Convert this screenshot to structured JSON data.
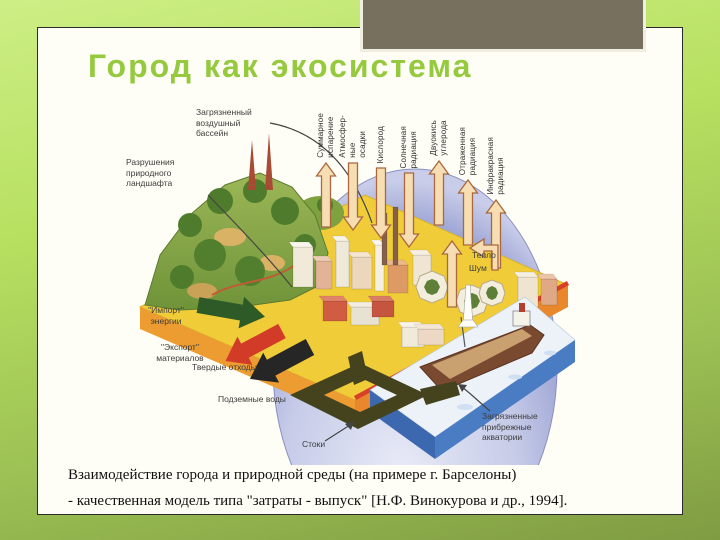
{
  "slide": {
    "title": "Город как экосистема",
    "caption": [
      "Взаимодействие города и природной среды (на примере г. Барселоны)",
      " - качественная модель типа \"затраты - выпуск\" [Н.Ф. Винокурова и др., 1994]."
    ]
  },
  "diagram": {
    "flows": [
      {
        "id": "total-evaporation",
        "label": "Суммарное\nиспарение",
        "dir": "up",
        "x": 206,
        "y_base": 132,
        "y_tip": 68,
        "label_bottom": 63
      },
      {
        "id": "atmospheric-precipitation",
        "label": "Атмосфер-\nные\nосадки",
        "dir": "down",
        "x": 233,
        "y_base": 68,
        "y_tip": 135,
        "label_bottom": 63
      },
      {
        "id": "oxygen",
        "label": "Кислород",
        "dir": "down",
        "x": 261,
        "y_base": 73,
        "y_tip": 143,
        "label_bottom": 68
      },
      {
        "id": "solar-radiation",
        "label": "Солнечная\nрадиация",
        "dir": "down",
        "x": 289,
        "y_base": 78,
        "y_tip": 152,
        "label_bottom": 73
      },
      {
        "id": "carbon-dioxide",
        "label": "Двуокись\nуглерода",
        "dir": "up",
        "x": 319,
        "y_base": 130,
        "y_tip": 66,
        "label_bottom": 61
      },
      {
        "id": "reflected-radiation",
        "label": "Отраженная\nрадиация",
        "dir": "up",
        "x": 348,
        "y_base": 150,
        "y_tip": 85,
        "label_bottom": 80
      },
      {
        "id": "infrared-radiation",
        "label": "Инфракрасная\nрадиация",
        "dir": "up",
        "x": 376,
        "y_base": 173,
        "y_tip": 105,
        "label_bottom": 100
      }
    ],
    "side_labels": [
      {
        "id": "polluted-air-basin-label",
        "text": "Загрязненный\nвоздушный\nбассейн",
        "x": 76,
        "y": 12
      },
      {
        "id": "landscape-destruction-label",
        "text": "Разрушения\nприродного\nландшафта",
        "x": 6,
        "y": 62
      },
      {
        "id": "energy-import-label",
        "text": "\"Импорт\"\nэнергии",
        "x": 10,
        "y": 210,
        "w": 72
      },
      {
        "id": "materials-export-label",
        "text": "\"Экспорт\"\nматериалов",
        "x": 14,
        "y": 247,
        "w": 92
      },
      {
        "id": "solid-waste-label",
        "text": "Твердые отходы",
        "x": 72,
        "y": 267
      },
      {
        "id": "groundwater-label",
        "text": "Подземные воды",
        "x": 98,
        "y": 299
      },
      {
        "id": "runoff-label",
        "text": "Стоки",
        "x": 182,
        "y": 344
      },
      {
        "id": "heat-label",
        "text": "Тепло",
        "x": 352,
        "y": 155
      },
      {
        "id": "noise-label",
        "text": "Шум",
        "x": 349,
        "y": 168
      },
      {
        "id": "polluted-coastal-waters-label",
        "text": "Загрязненные\nприбрежные\nакватории",
        "x": 362,
        "y": 316
      }
    ]
  },
  "colors": {
    "title_green": "#95c93e",
    "frame_green": "#b7e060",
    "gray_panel": "#77705f",
    "slide_bg": "#fffef6",
    "flow_arrow_fill": "#f6ddb2",
    "flow_arrow_outline": "#a9683f",
    "import_arrow_green": "#2d5a26",
    "export_arrow_red": "#d23b27",
    "waste_arrow_black": "#262626",
    "dome_blue": "#9ba3d3",
    "platform_yellow": "#f0cd38",
    "platform_edge_orange": "#ec9c30",
    "sea_blue": "#4a7cc4",
    "channel_olive": "#45431d"
  }
}
